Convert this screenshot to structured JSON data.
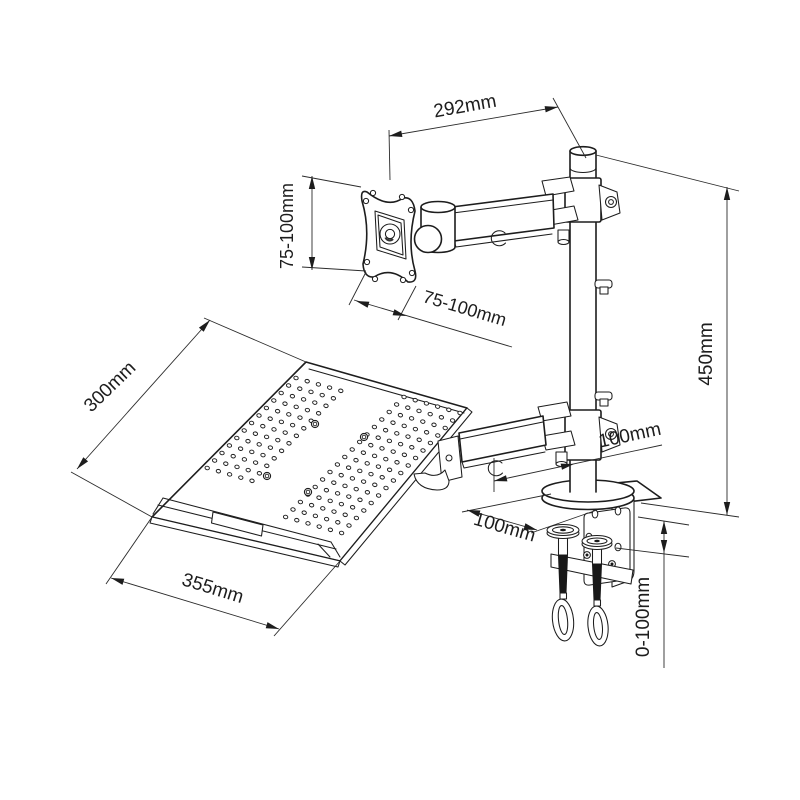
{
  "canvas": {
    "background": "#ffffff",
    "ink": "#1d1d1d"
  },
  "dimensions": {
    "arm_length": "292mm",
    "vesa_height": "75-100mm",
    "vesa_width": "75-100mm",
    "tray_depth": "300mm",
    "tray_width": "355mm",
    "pole_height": "450mm",
    "arm_offset": "100mm",
    "clamp_depth": "100mm",
    "clamp_range": "0-100mm"
  },
  "tray": {
    "perforation": {
      "u": [
        11.2,
        3.2
      ],
      "v": [
        -7.4,
        7.5
      ],
      "dot_rx": 2.2,
      "dot_ry": 1.75,
      "dot_angle": 15,
      "clusters": [
        {
          "origin": [
            296,
            378
          ],
          "cols": 5,
          "rows": 13
        },
        {
          "origin": [
            404,
            397
          ],
          "cols": 6,
          "rows": 17
        }
      ]
    },
    "mount_holes": [
      [
        315,
        424
      ],
      [
        364,
        437
      ],
      [
        267,
        476
      ],
      [
        308,
        492
      ]
    ]
  }
}
